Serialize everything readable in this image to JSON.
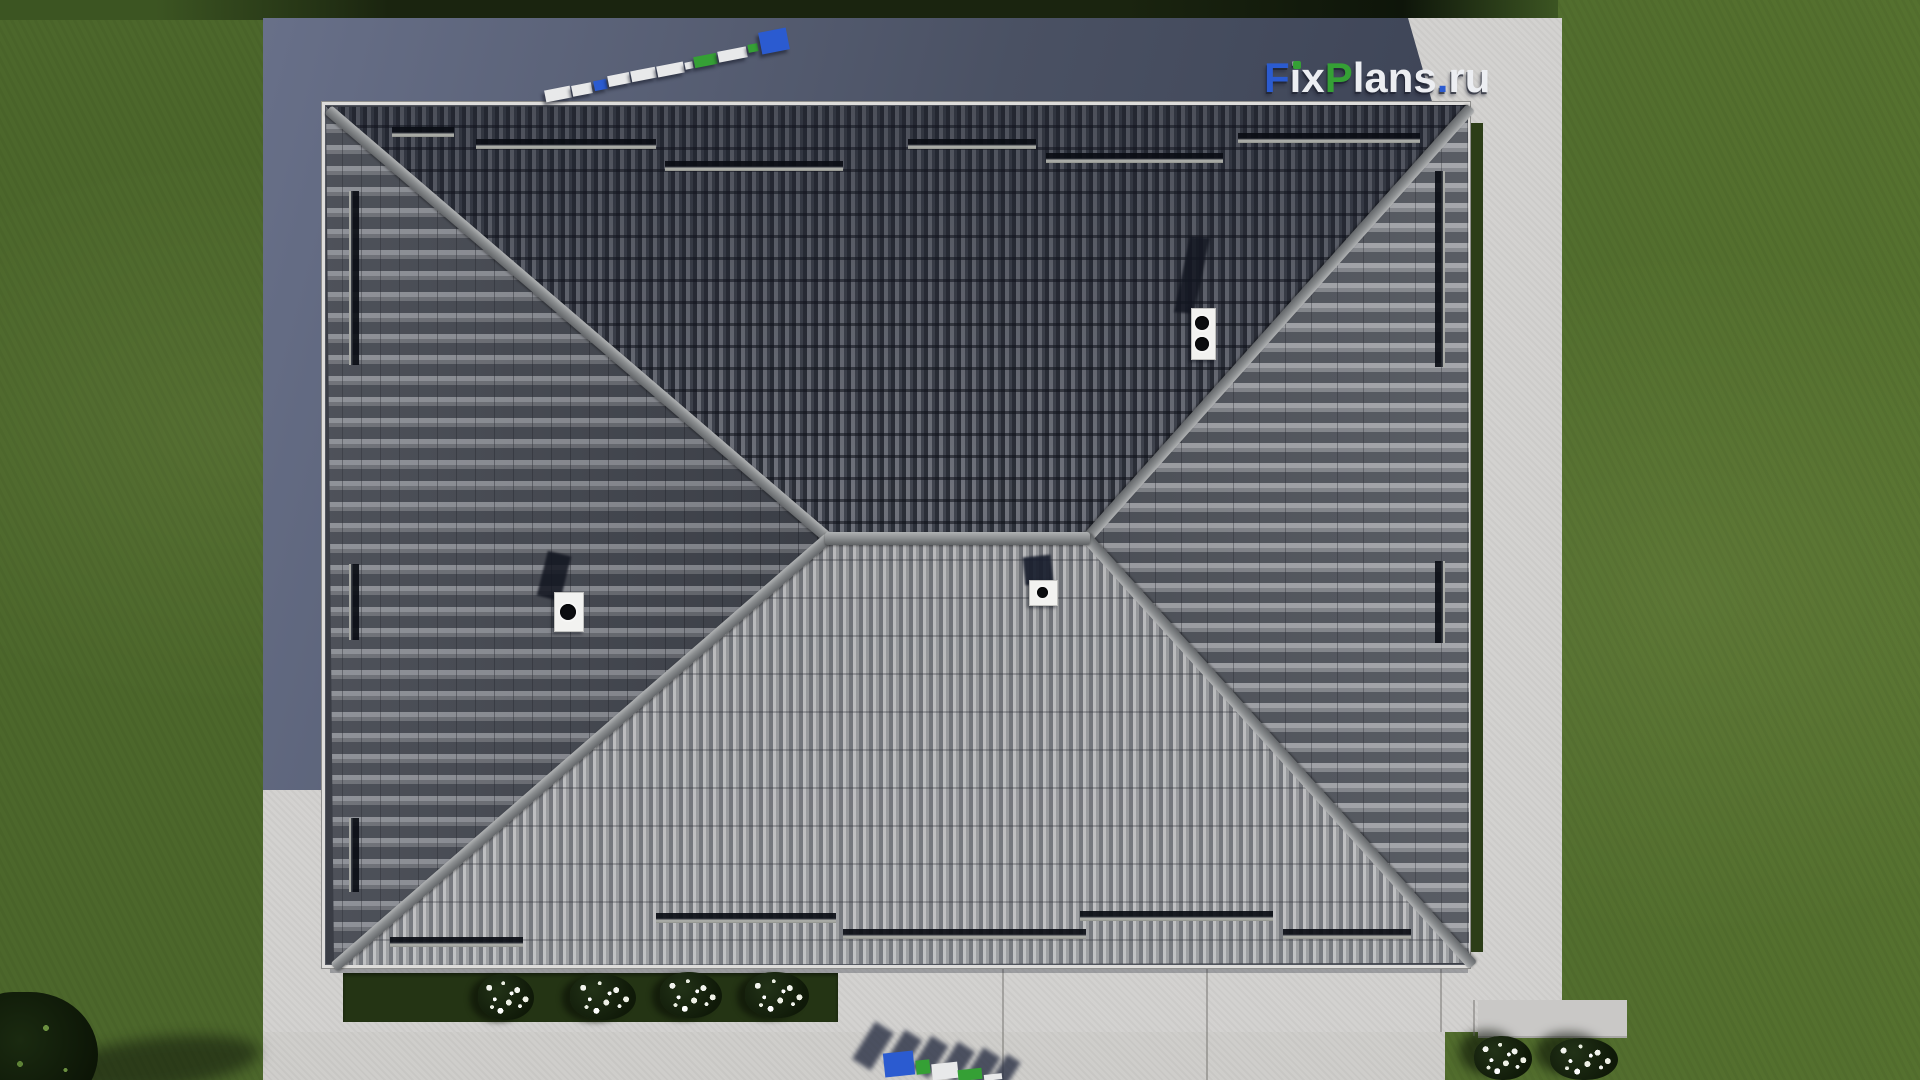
{
  "watermark": {
    "text": "FixPlans.ru",
    "letters": [
      {
        "ch": "F",
        "color_role": "blue"
      },
      {
        "ch": "i",
        "color_role": "white",
        "dot": "green"
      },
      {
        "ch": "x",
        "color_role": "white"
      },
      {
        "ch": "P",
        "color_role": "green"
      },
      {
        "ch": "l",
        "color_role": "white"
      },
      {
        "ch": "a",
        "color_role": "white"
      },
      {
        "ch": "n",
        "color_role": "white"
      },
      {
        "ch": "s",
        "color_role": "white"
      },
      {
        "ch": ".",
        "color_role": "blue"
      },
      {
        "ch": "r",
        "color_role": "white"
      },
      {
        "ch": "u",
        "color_role": "white"
      }
    ]
  },
  "logos_3d": {
    "top_left_blocks": "FixPlans.ru (extruded 3D letters seen from above)",
    "bottom_blocks": "FixPlans.ru (extruded 3D letters seen from above, cut by image edge)"
  },
  "scene_counts": {
    "roof_faces": 4,
    "chimney_double_flue": 1,
    "roof_vents": 2,
    "snow_guard_bars_top": 6,
    "snow_guard_bars_bottom": 5,
    "snow_guard_bars_left": 3,
    "snow_guard_bars_right": 2,
    "flower_bushes_front_bed": 4,
    "flower_bushes_corner": 2
  },
  "palette": {
    "grass": "#4c672b",
    "grassLight": "#55712f",
    "hedge": "#1a240f",
    "hedgeLit": "#3c5522",
    "concrete": "#d3d2d0",
    "concreteLow": "#cfcecb",
    "shadow1": "#687089",
    "shadow2": "#3a4153",
    "fascia": "#dedddb",
    "ridge": "#8e9193",
    "barEdge": "#a9aba6",
    "bed": "#243414",
    "flower": "#f2f4ee",
    "capWhite": "#f2f2f0",
    "flue": "#0c0d10",
    "white": "#eceef2",
    "blue": "#2b5bd0",
    "green": "#35a035"
  }
}
